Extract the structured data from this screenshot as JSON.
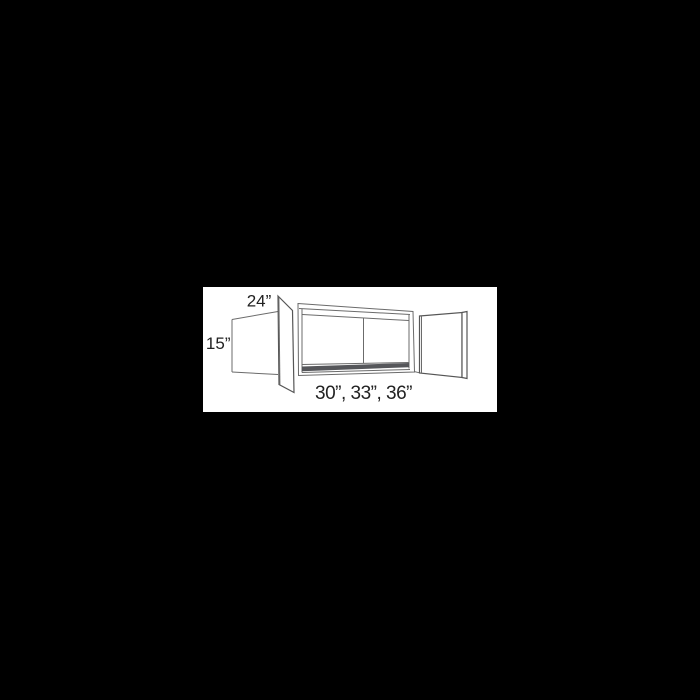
{
  "diagram": {
    "kind": "wall-cabinet-dimension-diagram",
    "labels": {
      "depth": "24”",
      "height": "15”",
      "widths": "30”, 33”, 36”"
    },
    "colors": {
      "background": "#000000",
      "panel": "#ffffff",
      "line": "#6b6b6b",
      "door_line": "#565656",
      "text": "#222222",
      "shelf_shade": "#55565a"
    }
  }
}
